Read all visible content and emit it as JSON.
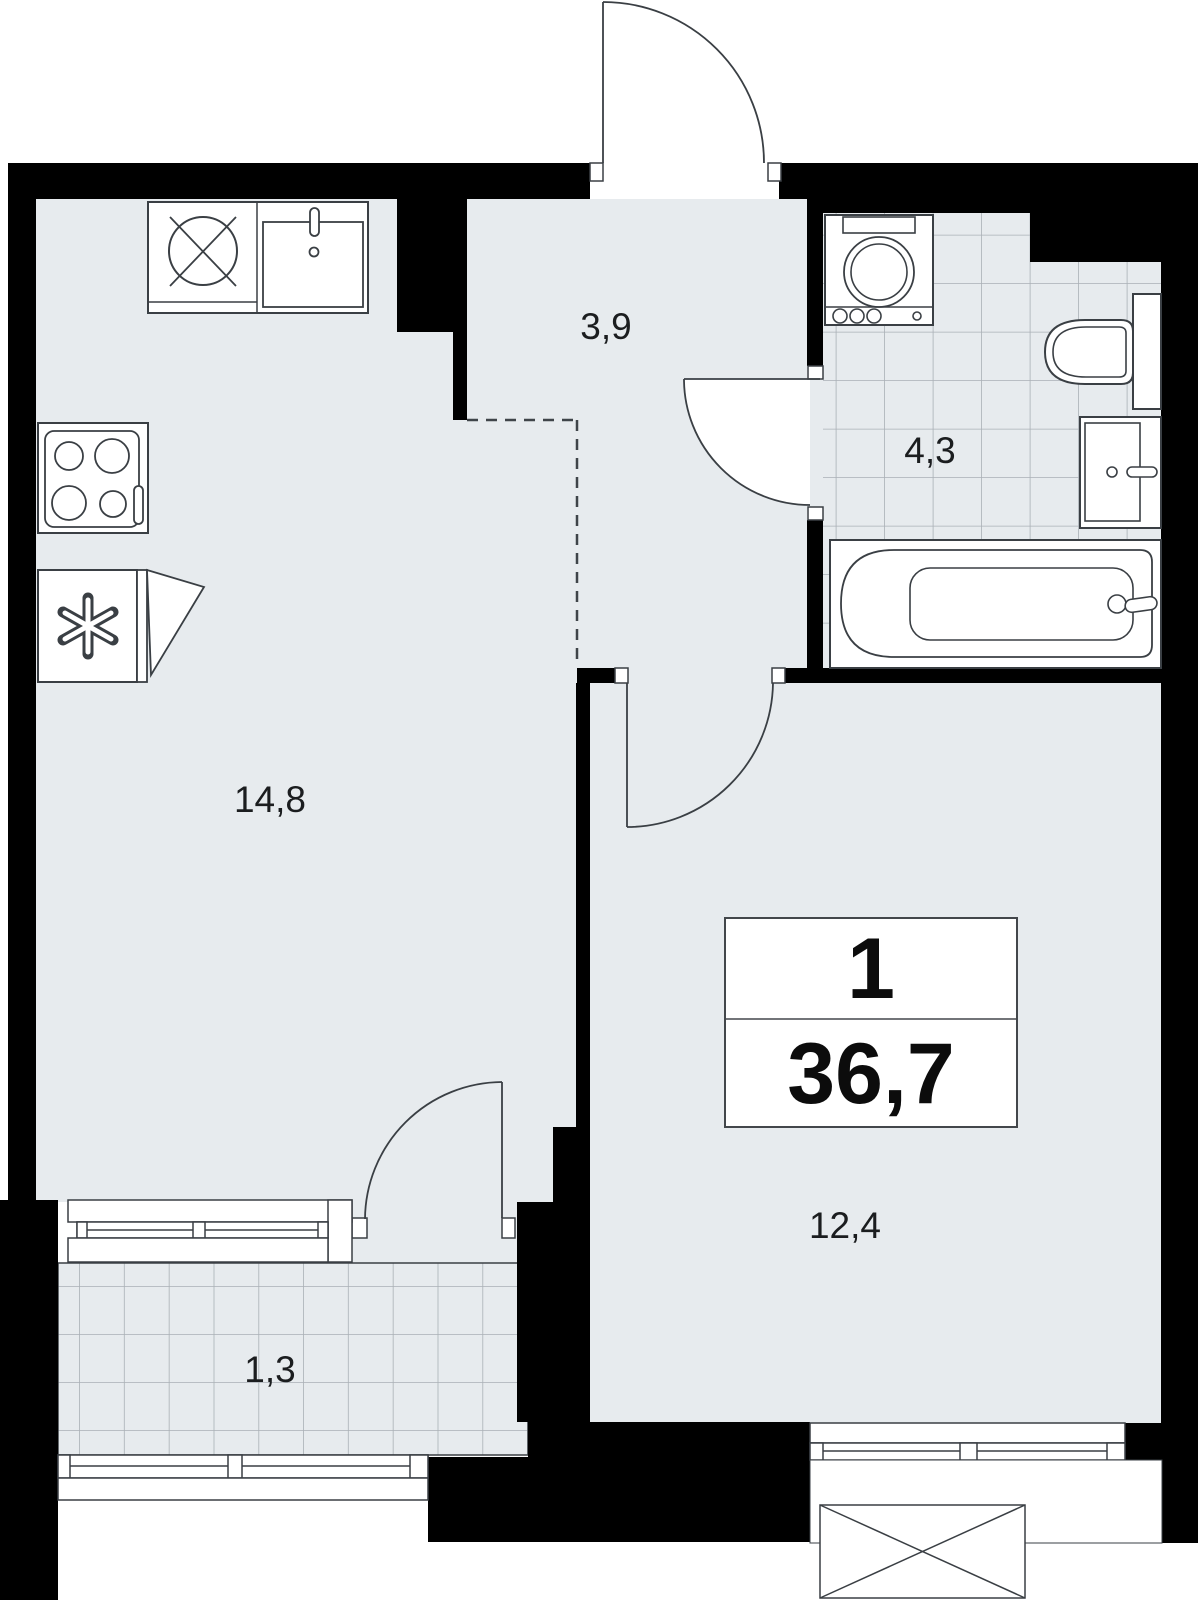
{
  "page": {
    "type": "apartment-floor-plan"
  },
  "plan": {
    "info_box": {
      "rooms_count": "1",
      "total_area": "36,7"
    },
    "rooms": [
      {
        "name": "kitchen-living-room",
        "area_label": "14,8"
      },
      {
        "name": "hallway",
        "area_label": "3,9"
      },
      {
        "name": "bathroom",
        "area_label": "4,3"
      },
      {
        "name": "bedroom",
        "area_label": "12,4"
      },
      {
        "name": "balcony",
        "area_label": "1,3"
      }
    ],
    "colors": {
      "wall": "#000000",
      "floor": "#e7ebee",
      "tile_grid": "#aab0b6",
      "outline": "#3a3f44",
      "background": "#ffffff"
    },
    "icons": [
      {
        "name": "entrance-door-icon"
      },
      {
        "name": "stove-icon"
      },
      {
        "name": "fridge-icon"
      },
      {
        "name": "kitchen-sink-icon"
      },
      {
        "name": "dishwasher-icon"
      },
      {
        "name": "washing-machine-icon"
      },
      {
        "name": "toilet-icon"
      },
      {
        "name": "washbasin-icon"
      },
      {
        "name": "bathtub-icon"
      }
    ]
  }
}
